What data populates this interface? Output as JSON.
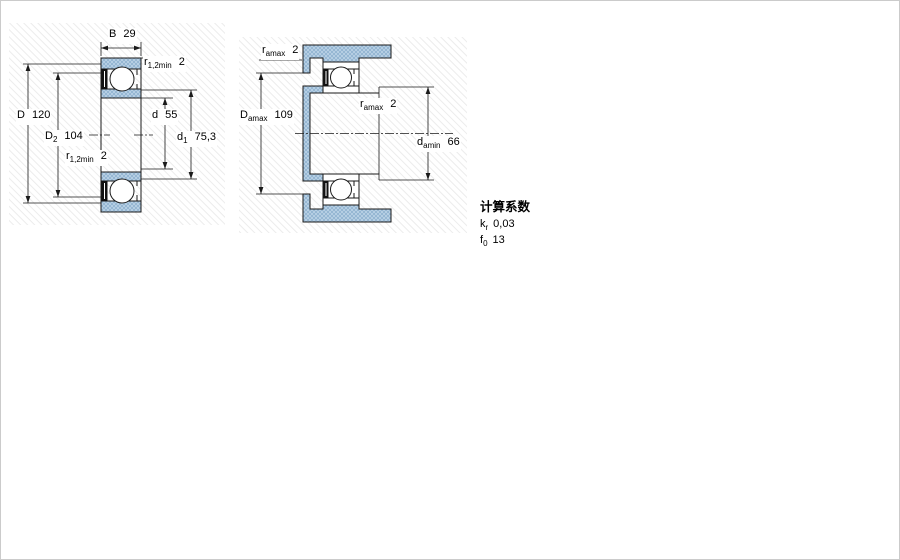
{
  "figure_left": {
    "dimensions": [
      {
        "symbol": "B",
        "sub": "",
        "value": "29"
      },
      {
        "symbol": "r",
        "sub": "1,2min",
        "value": "2"
      },
      {
        "symbol": "D",
        "sub": "",
        "value": "120"
      },
      {
        "symbol": "D",
        "sub": "2",
        "value": "104"
      },
      {
        "symbol": "r",
        "sub": "1,2min",
        "value": "2"
      },
      {
        "symbol": "d",
        "sub": "",
        "value": "55"
      },
      {
        "symbol": "d",
        "sub": "1",
        "value": "75,3"
      }
    ]
  },
  "figure_right": {
    "dimensions": [
      {
        "symbol": "r",
        "sub": "amax",
        "value": "2"
      },
      {
        "symbol": "D",
        "sub": "amax",
        "value": "109"
      },
      {
        "symbol": "r",
        "sub": "amax",
        "value": "2"
      },
      {
        "symbol": "d",
        "sub": "amin",
        "value": "66"
      }
    ]
  },
  "calculation_factors": {
    "heading": "计算系数",
    "factors": [
      {
        "symbol": "k",
        "sub": "r",
        "value": "0,03"
      },
      {
        "symbol": "f",
        "sub": "0",
        "value": "13"
      }
    ]
  },
  "colors": {
    "part_fill_light": "#b5cee3",
    "part_fill_dot": "#96b7d3",
    "line": "#1a1a1a"
  }
}
